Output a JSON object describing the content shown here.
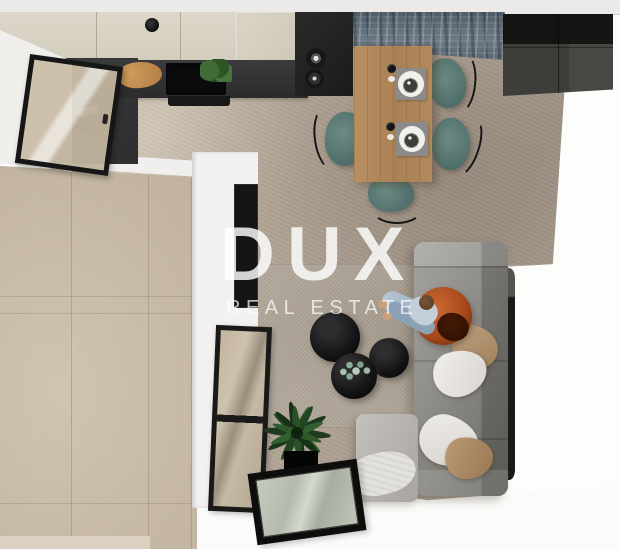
{
  "watermark": {
    "title": "DUX",
    "subtitle": "REAL ESTATE"
  },
  "colors": {
    "watermark_text": "#ffffff",
    "floor_tiles": "#cbbda9",
    "living_floor": "#b3a697",
    "kitchen_cabinets": "#d8d3c4",
    "countertop": "#343437",
    "accent_wall": "#5d6a73",
    "dining_table_wood": "#ae865a",
    "dining_chairs": "#5e7d79",
    "sofa": "#8e8c88",
    "hanging_chair": "#a8491d",
    "rug": "#b0a699",
    "pillow_tan": "#b29574"
  }
}
